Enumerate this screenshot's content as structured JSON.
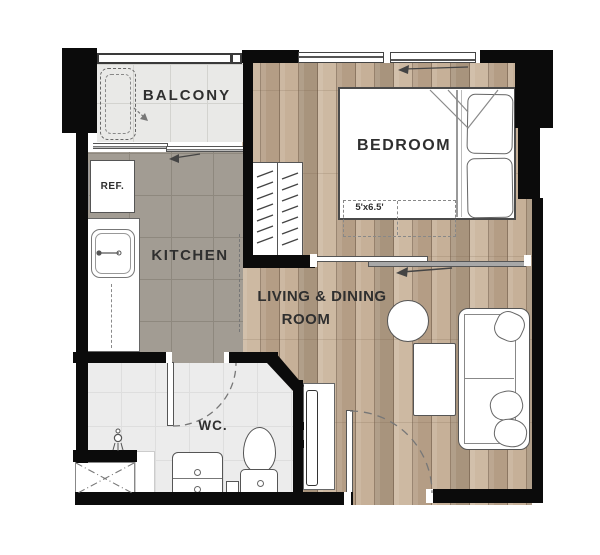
{
  "plan": {
    "type": "apartment-floor-plan",
    "colors": {
      "wall": "#0b0b0b",
      "wood_floor": "#c2ad95",
      "kitchen_floor": "#a29c93",
      "balcony_floor": "#e9e9e7",
      "wc_floor": "#ececec",
      "label_text": "#2f2f2f"
    }
  },
  "rooms": {
    "balcony": {
      "label": "BALCONY"
    },
    "kitchen": {
      "label": "KITCHEN"
    },
    "bedroom": {
      "label": "BEDROOM",
      "dimension": "5'x6.5'"
    },
    "living_dining": {
      "line1": "LIVING & DINING",
      "line2": "ROOM"
    },
    "wc": {
      "label": "WC."
    }
  },
  "appliances": {
    "refrigerator": {
      "label": "REF."
    }
  },
  "symbols": [
    "washing-machine-icon",
    "sliding-window-icon",
    "wardrobe-hangers-icon",
    "double-bed-icon",
    "pillow-icon",
    "kitchen-sink-icon",
    "shower-head-icon",
    "shower-shaft-icon",
    "vanity-basin-icon",
    "toilet-icon",
    "door-swing-arc-icon",
    "tv-console-icon",
    "round-table-icon",
    "coffee-table-icon",
    "sofa-icon"
  ]
}
